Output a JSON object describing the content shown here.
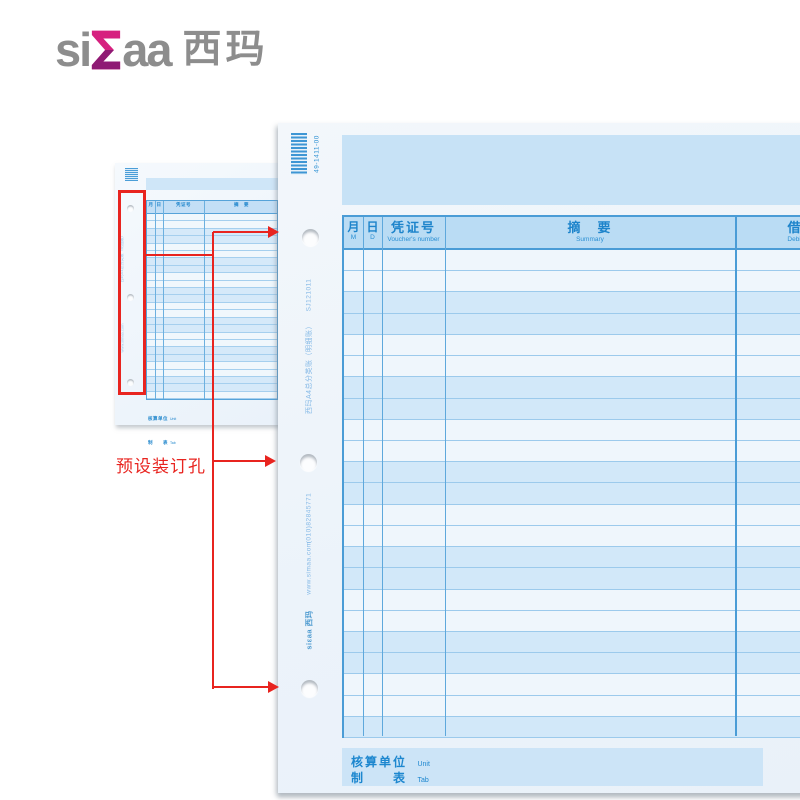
{
  "logo": {
    "part1": "si",
    "part2": "aa",
    "cn": "西玛"
  },
  "annotation": {
    "label": "预设装订孔"
  },
  "form": {
    "barcode_text": "49-1411-00",
    "side": {
      "product_code": "SJ121011",
      "product_name": "西玛A4总分类账（明细账）",
      "phone": "(010)82845771",
      "website": "www.simaa.com",
      "brand": "siεaa 西玛"
    },
    "table": {
      "columns": [
        {
          "cn": "月",
          "en": "M"
        },
        {
          "cn": "日",
          "en": "D"
        },
        {
          "cn": "凭证号",
          "en": "Voucher's number"
        },
        {
          "cn": "摘　要",
          "en": "Summary"
        },
        {
          "cn": "借",
          "en": "Debit"
        }
      ],
      "row_count": 23
    },
    "footer": {
      "unit_cn": "核算单位",
      "unit_en": "Unit",
      "tab_cn": "制　　表",
      "tab_en": "Tab"
    }
  },
  "thumbnail": {
    "row_count": 25
  },
  "colors": {
    "accent_blue": "#2a8fd3",
    "annotation_red": "#e8241f",
    "paper_blue": "#cfe7f8"
  }
}
